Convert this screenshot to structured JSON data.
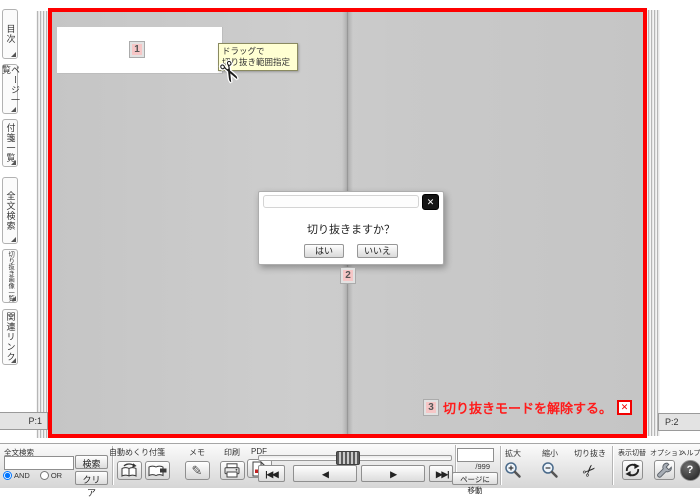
{
  "sidebar": {
    "tabs": [
      {
        "label": "目次"
      },
      {
        "label": "ページ一覧"
      },
      {
        "label": "付箋一覧"
      },
      {
        "label": "全文検索"
      },
      {
        "label": "切り抜き画像一覧"
      },
      {
        "label": "関連リンク"
      }
    ]
  },
  "viewer": {
    "page_tab_left": "P:1",
    "page_tab_right": "P:2",
    "step1_marker": "1",
    "step2_marker": "2",
    "step3_marker": "3",
    "tooltip_line1": "ドラッグで",
    "tooltip_line2": "切り抜き範囲指定",
    "dialog": {
      "message": "切り抜きますか？",
      "yes_button": "はい",
      "no_button": "いいえ"
    },
    "annotation3_text": "切り抜きモードを解除する。"
  },
  "toolbar": {
    "search_label": "全文検索",
    "search_button": "検索",
    "clear_button": "クリア",
    "and_label": "AND",
    "or_label": "OR",
    "tools": [
      {
        "label": "自動めくり"
      },
      {
        "label": "付箋"
      },
      {
        "label": "メモ"
      },
      {
        "label": "印刷"
      },
      {
        "label": "PDF"
      }
    ],
    "page_input_value": "",
    "page_total": "/999",
    "page_jump_button": "ページに移動",
    "zoom_in_label": "拡大",
    "zoom_out_label": "縮小",
    "clip_label": "切り抜き",
    "display_toggle_label": "表示切替",
    "options_label": "オプション",
    "help_label": "ヘルプ"
  },
  "icons": {
    "close": "✕",
    "cancel_x": "✕",
    "scissors": "✂",
    "pencil": "✎",
    "help": "?",
    "nav_first": "|◀◀",
    "nav_prev": "◀",
    "nav_next": "▶",
    "nav_last": "▶▶|"
  },
  "colors": {
    "frame_red": "#fe0000",
    "page_gray": "#c9c9c9",
    "tooltip_bg": "#ffffd2",
    "marker_pink": "#f6c6c6",
    "annotation_red": "#ff1c1c"
  }
}
